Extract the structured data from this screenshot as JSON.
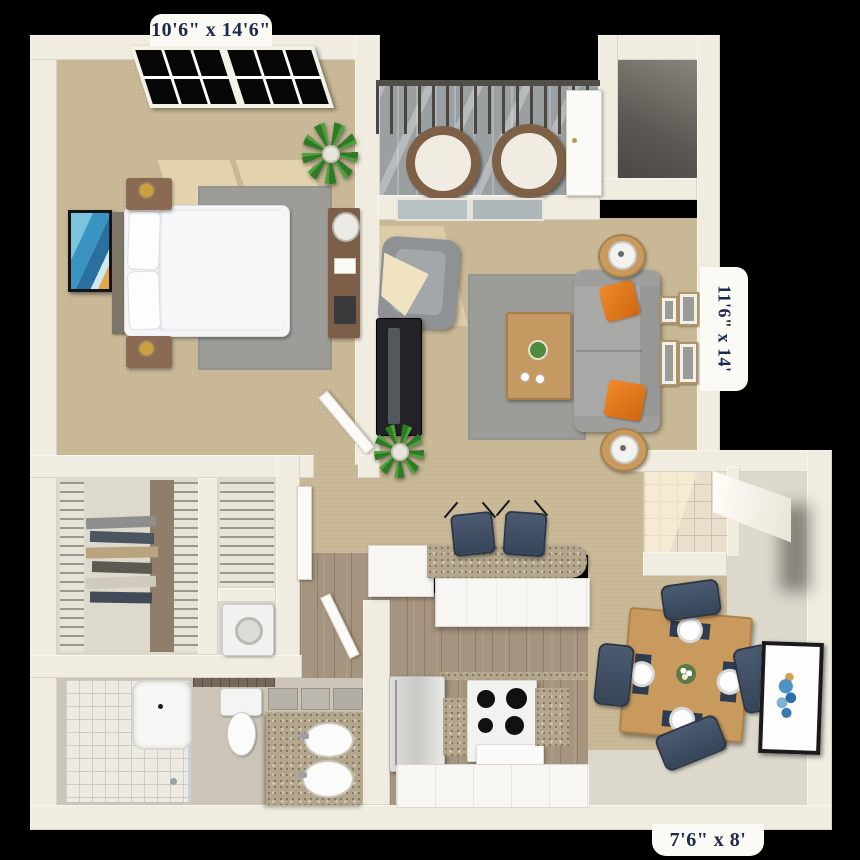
{
  "page": {
    "type": "3d-floor-plan-rendering",
    "background": "#000000"
  },
  "labels": {
    "bedroom": "10'6\" x 14'6\"",
    "living_room": "11'6\" x 14'",
    "kitchen": "7'6\" x 8'"
  },
  "rooms": [
    "bedroom",
    "balcony",
    "storage-closet",
    "living-room",
    "hallway",
    "walk-in-closet",
    "linen-closet",
    "laundry-closet",
    "bathroom",
    "kitchen",
    "dining-area",
    "entry"
  ],
  "furniture": [
    "queen-bed",
    "nightstands",
    "desk",
    "area-rug",
    "tv-console",
    "armchair",
    "sofa",
    "coffee-table",
    "side-tables",
    "gallery-frames",
    "patio-chairs",
    "bar-stools",
    "breakfast-bar",
    "refrigerator",
    "stove",
    "dining-table",
    "dining-chairs",
    "washer",
    "bathtub-shower",
    "toilet",
    "double-vanity",
    "wall-art",
    "plants"
  ],
  "colors": {
    "wall": "#f0ecdf",
    "carpet": "#c7b795",
    "rug": "#9c9c98",
    "wood": "#a5947f",
    "balcony": "#9aa0a2",
    "tile": "#e9dfcc",
    "tileline": "#cdc1ab",
    "bath": "#ccc5b7",
    "closet": "#ddd9cd",
    "greige": "#dcd8cc",
    "granite": "#b3a68c",
    "sofa": "#a8a8a6",
    "navy": "#3c4a5d",
    "orange": "#de7519",
    "tablewood": "#c89a5d",
    "white": "#f7f6f2",
    "door": "#fbfaf6",
    "labelbg": "#fbfaf4",
    "labeltext": "#1e2a4d"
  }
}
